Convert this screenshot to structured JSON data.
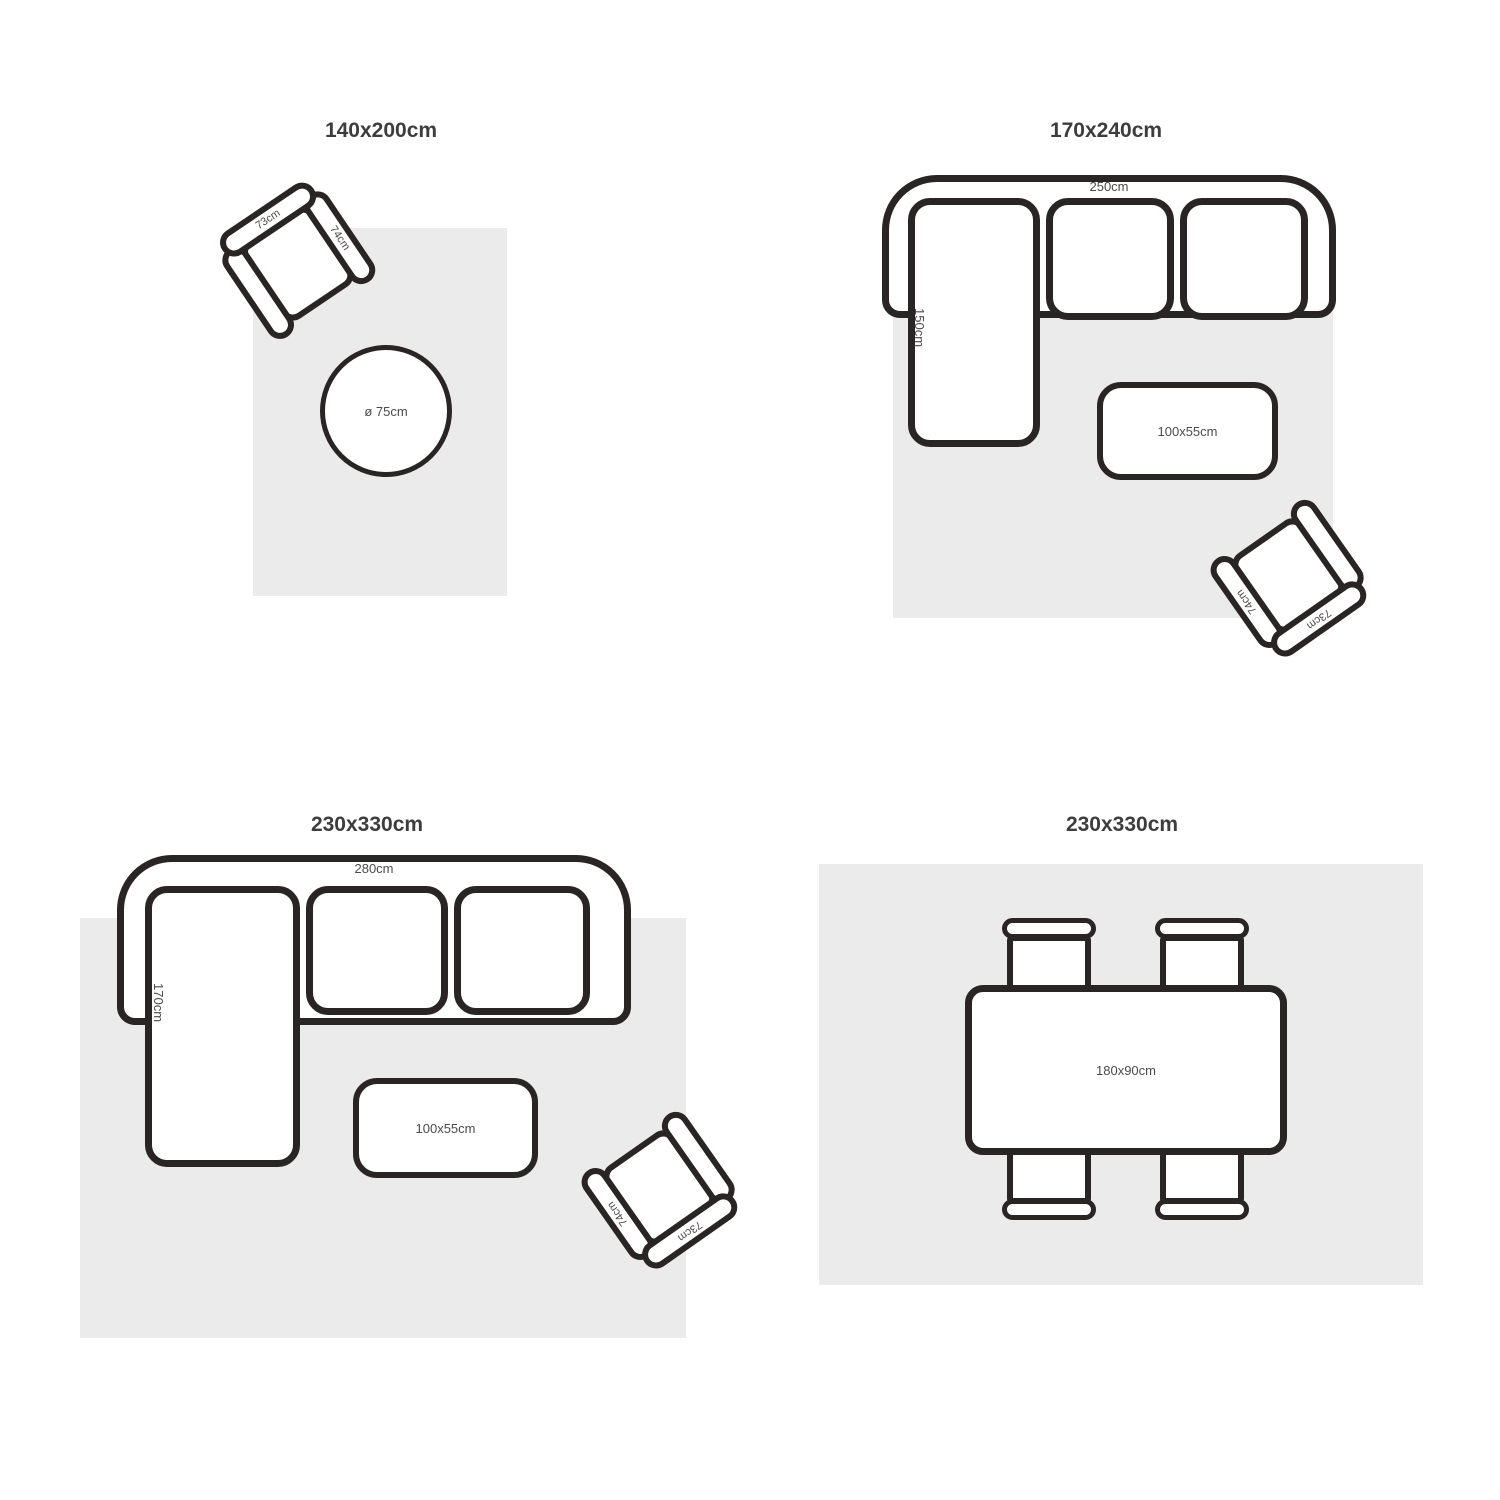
{
  "colors": {
    "outline": "#2a2525",
    "rug": "#ebebeb",
    "label_text": "#4b4b4b",
    "title_text": "#3d3d3d",
    "background": "#ffffff"
  },
  "layouts": [
    {
      "title": "140x200cm",
      "armchair": {
        "back_label": "73cm",
        "arm_label": "74cm"
      },
      "round_table_label": "ø 75cm"
    },
    {
      "title": "170x240cm",
      "sofa": {
        "width_label": "250cm",
        "chaise_label": "150cm"
      },
      "coffee_table_label": "100x55cm",
      "armchair": {
        "back_label": "73cm",
        "arm_label": "74cm"
      }
    },
    {
      "title": "230x330cm",
      "sofa": {
        "width_label": "280cm",
        "chaise_label": "170cm"
      },
      "coffee_table_label": "100x55cm",
      "armchair": {
        "back_label": "73cm",
        "arm_label": "74cm"
      }
    },
    {
      "title": "230x330cm",
      "dining_table_label": "180x90cm"
    }
  ]
}
